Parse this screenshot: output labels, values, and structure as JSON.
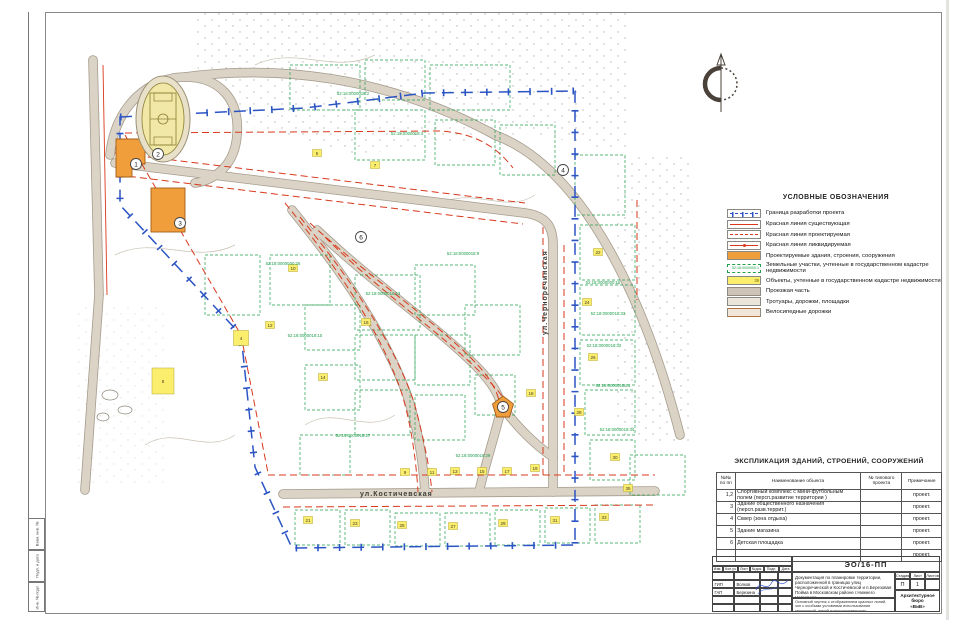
{
  "legend": {
    "title": "УСЛОВНЫЕ ОБОЗНАЧЕНИЯ",
    "items": [
      {
        "symbol": "boundary",
        "label": "Граница разработки проекта"
      },
      {
        "symbol": "redline-existing",
        "label": "Красная линия существующая"
      },
      {
        "symbol": "redline-planned",
        "label": "Красная линия проектируемая"
      },
      {
        "symbol": "redline-removed",
        "label": "Красная линия ликвидируемая"
      },
      {
        "symbol": "building-planned",
        "label": "Проектируемые здания, строения, сооружения"
      },
      {
        "symbol": "parcel-cadastre",
        "label": "Земельные участки, учтенные в государственном кадастре недвижимости",
        "sample": "52:18:0000000:1"
      },
      {
        "symbol": "object-cadastre",
        "label": "Объекты, учтенные в государственном кадастре недвижимости",
        "sample": "39"
      },
      {
        "symbol": "roadway",
        "label": "Проезжая часть"
      },
      {
        "symbol": "sidewalk",
        "label": "Тротуары, дорожки, площадки"
      },
      {
        "symbol": "bikeway",
        "label": "Велосипедные дорожки"
      }
    ]
  },
  "explication": {
    "title": "ЭКСПЛИКАЦИЯ ЗДАНИЙ, СТРОЕНИЙ, СООРУЖЕНИЙ",
    "columns": [
      "№№ по пп",
      "Наименование объекта",
      "№ типового проекта",
      "Примечание"
    ],
    "rows": [
      [
        "1,2",
        "Спортивный комплекс с мини-футбольным полем (персп.развитие территории )",
        "",
        "проект."
      ],
      [
        "3",
        "Здание общественного назначения (персп.разв.террит.)",
        "",
        "проект."
      ],
      [
        "4",
        "Сквер (зона отдыха)",
        "",
        "проект."
      ],
      [
        "5",
        "Здание магазина",
        "",
        "проект."
      ],
      [
        "6",
        "Детская площадка",
        "",
        "проект."
      ],
      [
        "",
        "",
        "",
        "проект."
      ]
    ]
  },
  "title_block": {
    "code": "ЭО/16-ПП",
    "description": "Документация по планировке территории, расположенной в границах улиц Черноречинской и Костичевской и п.Березовая Пойма в Московском районе г.Нижнего Новгорода",
    "rev_headers": [
      "Изм.",
      "Кол.уч",
      "Лист",
      "№док.",
      "Подп.",
      "Дата"
    ],
    "signers": [
      {
        "role": "",
        "name": ""
      },
      {
        "role": "ГИП",
        "name": "Волков"
      },
      {
        "role": "ГАП",
        "name": "Березина"
      },
      {
        "role": "",
        "name": ""
      },
      {
        "role": "",
        "name": ""
      }
    ],
    "stage_headers": [
      "Стадия",
      "Лист",
      "Листов"
    ],
    "stage_values": [
      "П",
      "1",
      ""
    ],
    "sheet_title": "Основной чертеж с отображением красных линий, зон с особыми условиями использования территорий, линий градостроительного регулирования. М 1:2000",
    "company_line1": "Архитектурное бюро",
    "company_line2": "«ВиВ»"
  },
  "frame": {
    "strip_labels": [
      "Взам. инв. №",
      "Подп. и дата",
      "Инв. № подл."
    ]
  },
  "map": {
    "streets": [
      {
        "label": "ул.Костичевская",
        "x": 305,
        "y": 491,
        "rotate": 0
      },
      {
        "label": "ул.Черноречинская",
        "x": 492,
        "y": 330,
        "rotate": -90
      }
    ],
    "object_markers": [
      {
        "n": "1",
        "x": 81,
        "y": 159
      },
      {
        "n": "2",
        "x": 103,
        "y": 149
      },
      {
        "n": "3",
        "x": 125,
        "y": 218
      },
      {
        "n": "4",
        "x": 508,
        "y": 165
      },
      {
        "n": "5",
        "x": 448,
        "y": 402
      },
      {
        "n": "6",
        "x": 306,
        "y": 232
      }
    ],
    "cadastral_labels": [
      {
        "text": "52:18:0000000:16",
        "x": 548,
        "y": 279
      },
      {
        "text": "52:18:0000018:33",
        "x": 553,
        "y": 310
      },
      {
        "text": "52:18:0000018:32",
        "x": 549,
        "y": 342
      },
      {
        "text": "52:18:0000018:21",
        "x": 558,
        "y": 382
      },
      {
        "text": "52:18:0000018:44",
        "x": 562,
        "y": 426
      },
      {
        "text": "52:18:0000018:2",
        "x": 298,
        "y": 90
      },
      {
        "text": "52:18:0000018:4",
        "x": 352,
        "y": 130
      },
      {
        "text": "52:18:0000000:26",
        "x": 228,
        "y": 260
      },
      {
        "text": "52:18:0000018:13",
        "x": 328,
        "y": 290
      },
      {
        "text": "52:18:0000018:15",
        "x": 250,
        "y": 332
      },
      {
        "text": "52:18:0000018:9",
        "x": 408,
        "y": 250
      },
      {
        "text": "52:18:0000018:17",
        "x": 298,
        "y": 432
      },
      {
        "text": "52:18:0000018:29",
        "x": 418,
        "y": 452
      }
    ],
    "yellow_markers": [
      {
        "x": 350,
        "y": 467,
        "n": "9"
      },
      {
        "x": 377,
        "y": 467,
        "n": "11"
      },
      {
        "x": 400,
        "y": 466,
        "n": "13"
      },
      {
        "x": 427,
        "y": 466,
        "n": "15"
      },
      {
        "x": 452,
        "y": 466,
        "n": "17"
      },
      {
        "x": 480,
        "y": 463,
        "n": "19"
      },
      {
        "x": 253,
        "y": 515,
        "n": "21"
      },
      {
        "x": 300,
        "y": 518,
        "n": "23"
      },
      {
        "x": 347,
        "y": 520,
        "n": "25"
      },
      {
        "x": 398,
        "y": 521,
        "n": "27"
      },
      {
        "x": 448,
        "y": 518,
        "n": "29"
      },
      {
        "x": 500,
        "y": 515,
        "n": "31"
      },
      {
        "x": 549,
        "y": 512,
        "n": "33"
      },
      {
        "x": 543,
        "y": 247,
        "n": "22"
      },
      {
        "x": 532,
        "y": 297,
        "n": "24"
      },
      {
        "x": 538,
        "y": 352,
        "n": "26"
      },
      {
        "x": 524,
        "y": 407,
        "n": "28"
      },
      {
        "x": 560,
        "y": 452,
        "n": "30"
      },
      {
        "x": 573,
        "y": 483,
        "n": "35"
      },
      {
        "x": 262,
        "y": 148,
        "n": "5"
      },
      {
        "x": 320,
        "y": 160,
        "n": "7"
      },
      {
        "x": 238,
        "y": 263,
        "n": "10"
      },
      {
        "x": 215,
        "y": 320,
        "n": "12"
      },
      {
        "x": 268,
        "y": 372,
        "n": "14"
      },
      {
        "x": 311,
        "y": 317,
        "n": "16"
      },
      {
        "x": 476,
        "y": 388,
        "n": "18"
      },
      {
        "x": 108,
        "y": 376,
        "n": "8",
        "w": 22,
        "h": 26
      },
      {
        "x": 186,
        "y": 333,
        "n": "4",
        "w": 15,
        "h": 15
      }
    ],
    "green_parcels": [
      [
        235,
        60,
        70,
        45
      ],
      [
        310,
        55,
        60,
        40
      ],
      [
        375,
        60,
        80,
        45
      ],
      [
        300,
        105,
        70,
        50
      ],
      [
        380,
        115,
        60,
        45
      ],
      [
        445,
        120,
        55,
        50
      ],
      [
        215,
        250,
        60,
        50
      ],
      [
        250,
        300,
        55,
        45
      ],
      [
        300,
        270,
        65,
        55
      ],
      [
        360,
        260,
        60,
        50
      ],
      [
        300,
        330,
        60,
        45
      ],
      [
        360,
        330,
        55,
        50
      ],
      [
        250,
        360,
        55,
        45
      ],
      [
        300,
        385,
        55,
        45
      ],
      [
        360,
        390,
        50,
        45
      ],
      [
        410,
        300,
        55,
        50
      ],
      [
        420,
        370,
        40,
        40
      ],
      [
        520,
        150,
        50,
        60
      ],
      [
        525,
        220,
        55,
        55
      ],
      [
        525,
        280,
        55,
        50
      ],
      [
        525,
        335,
        55,
        45
      ],
      [
        530,
        385,
        50,
        45
      ],
      [
        535,
        435,
        45,
        40
      ],
      [
        240,
        505,
        45,
        35
      ],
      [
        290,
        505,
        45,
        35
      ],
      [
        340,
        508,
        45,
        33
      ],
      [
        390,
        508,
        45,
        33
      ],
      [
        440,
        505,
        45,
        35
      ],
      [
        490,
        503,
        45,
        35
      ],
      [
        540,
        500,
        45,
        38
      ],
      [
        245,
        430,
        50,
        40
      ],
      [
        150,
        250,
        55,
        60
      ],
      [
        575,
        450,
        55,
        40
      ]
    ]
  }
}
